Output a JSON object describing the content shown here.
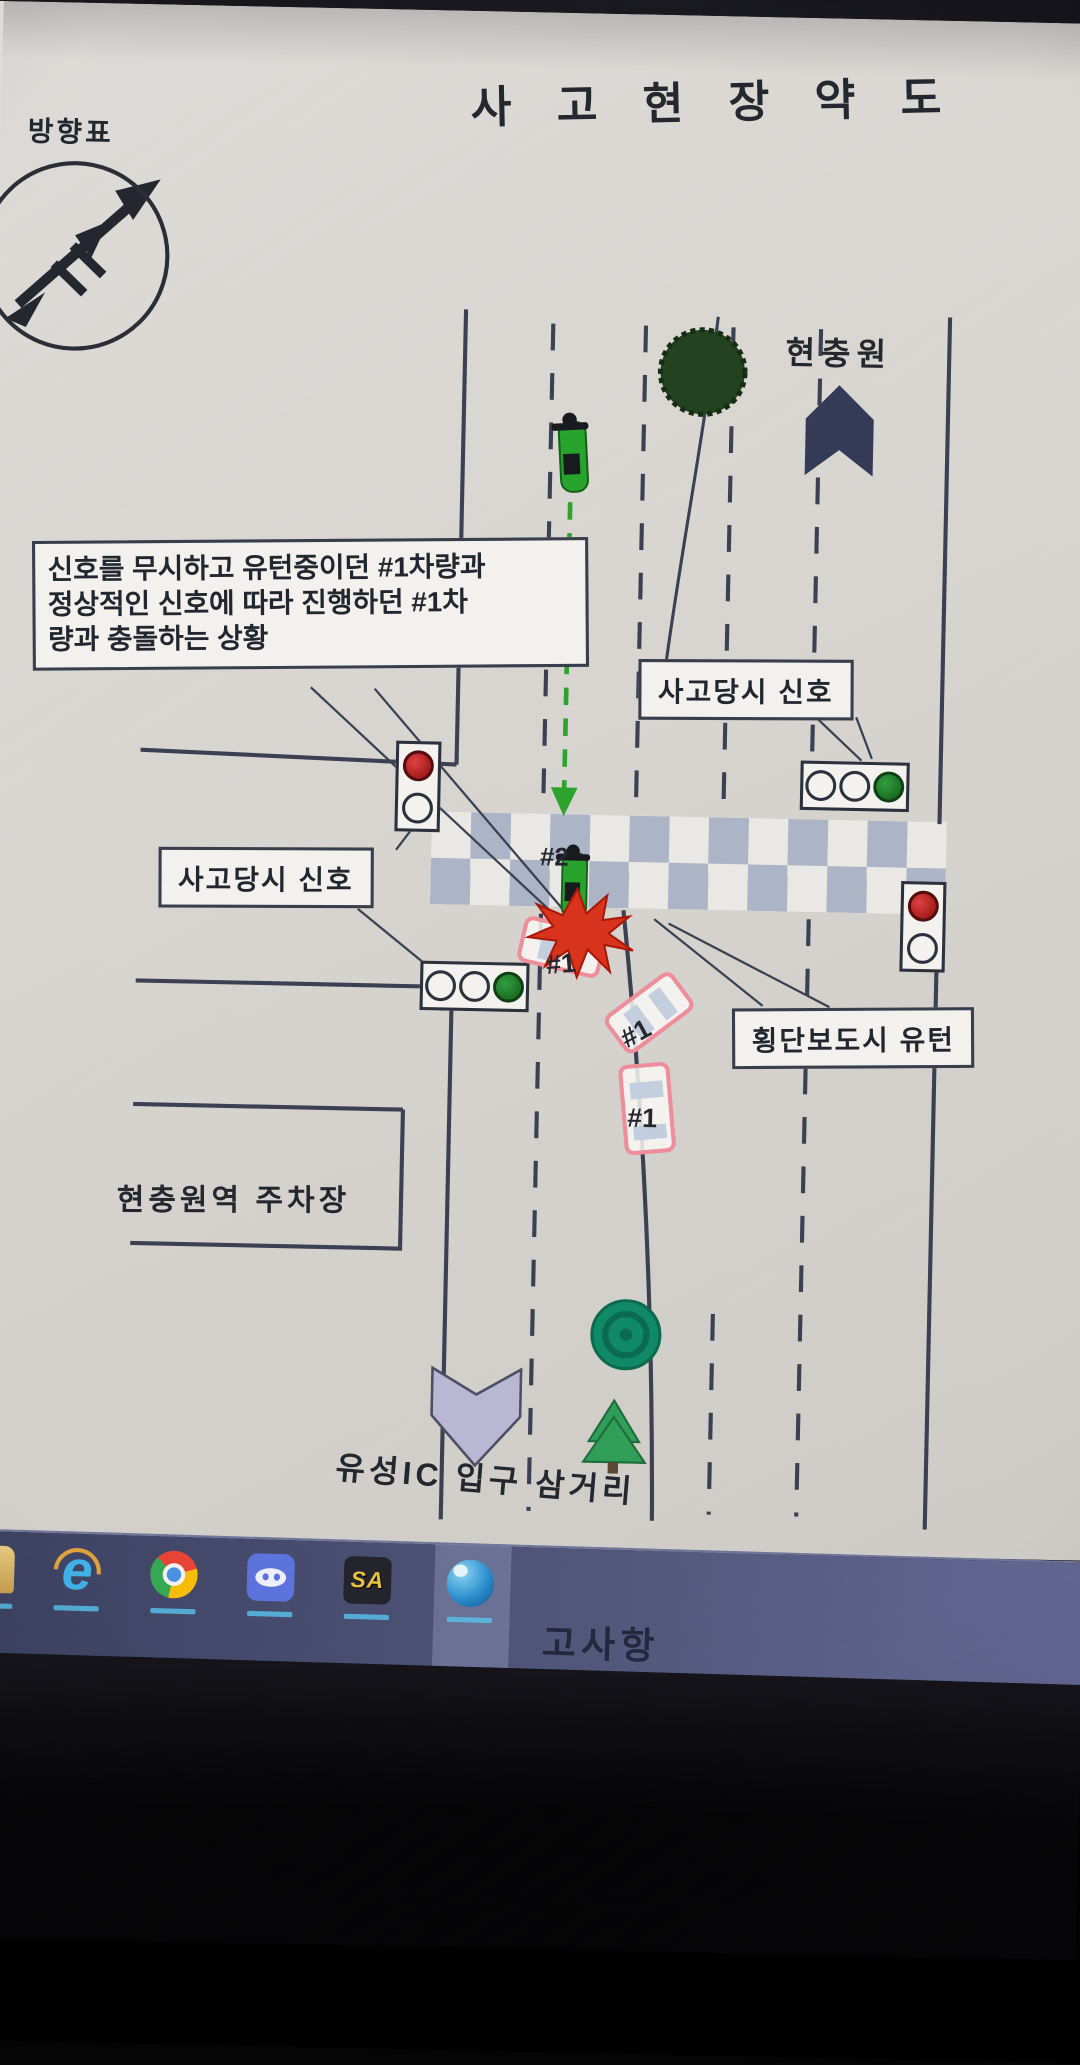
{
  "screen": {
    "title": "사 고 현 장 약 도"
  },
  "compass": {
    "label": "방향표"
  },
  "places": {
    "hyeonchungwon": "현충원",
    "parking": "현충원역 주차장",
    "junction": "유성IC 입구 삼거리"
  },
  "callout": {
    "line1": "신호를 무시하고 유턴중이던 #1차량과",
    "line2": "정상적인 신호에 따라 진행하던 #1차",
    "line3": "량과 충돌하는 상황"
  },
  "boxes": {
    "signal_right": "사고당시 신호",
    "signal_left": "사고당시 신호",
    "uturn": "횡단보도시 유턴"
  },
  "vehicles": {
    "car_label": "#1",
    "moto_label": "#2"
  },
  "taskbar": {
    "window_label": "고사항",
    "sa_text": "SA",
    "ie_glyph": "e",
    "icons": [
      "file-explorer",
      "internet-explorer",
      "chrome",
      "discord",
      "gta-san-andreas",
      "blue-p-app"
    ]
  },
  "colors": {
    "signal_red": "#b51212",
    "signal_green": "#1d7a1f",
    "car_outline": "#ee8e9a",
    "moto_green": "#27a42b",
    "arrow_green": "#2ca32c",
    "crosswalk_square": "#a9b3c7",
    "navy_shape": "#323a56",
    "lavender_arrow": "#b9b7d4",
    "taskbar_bg": "#4a4f74"
  }
}
